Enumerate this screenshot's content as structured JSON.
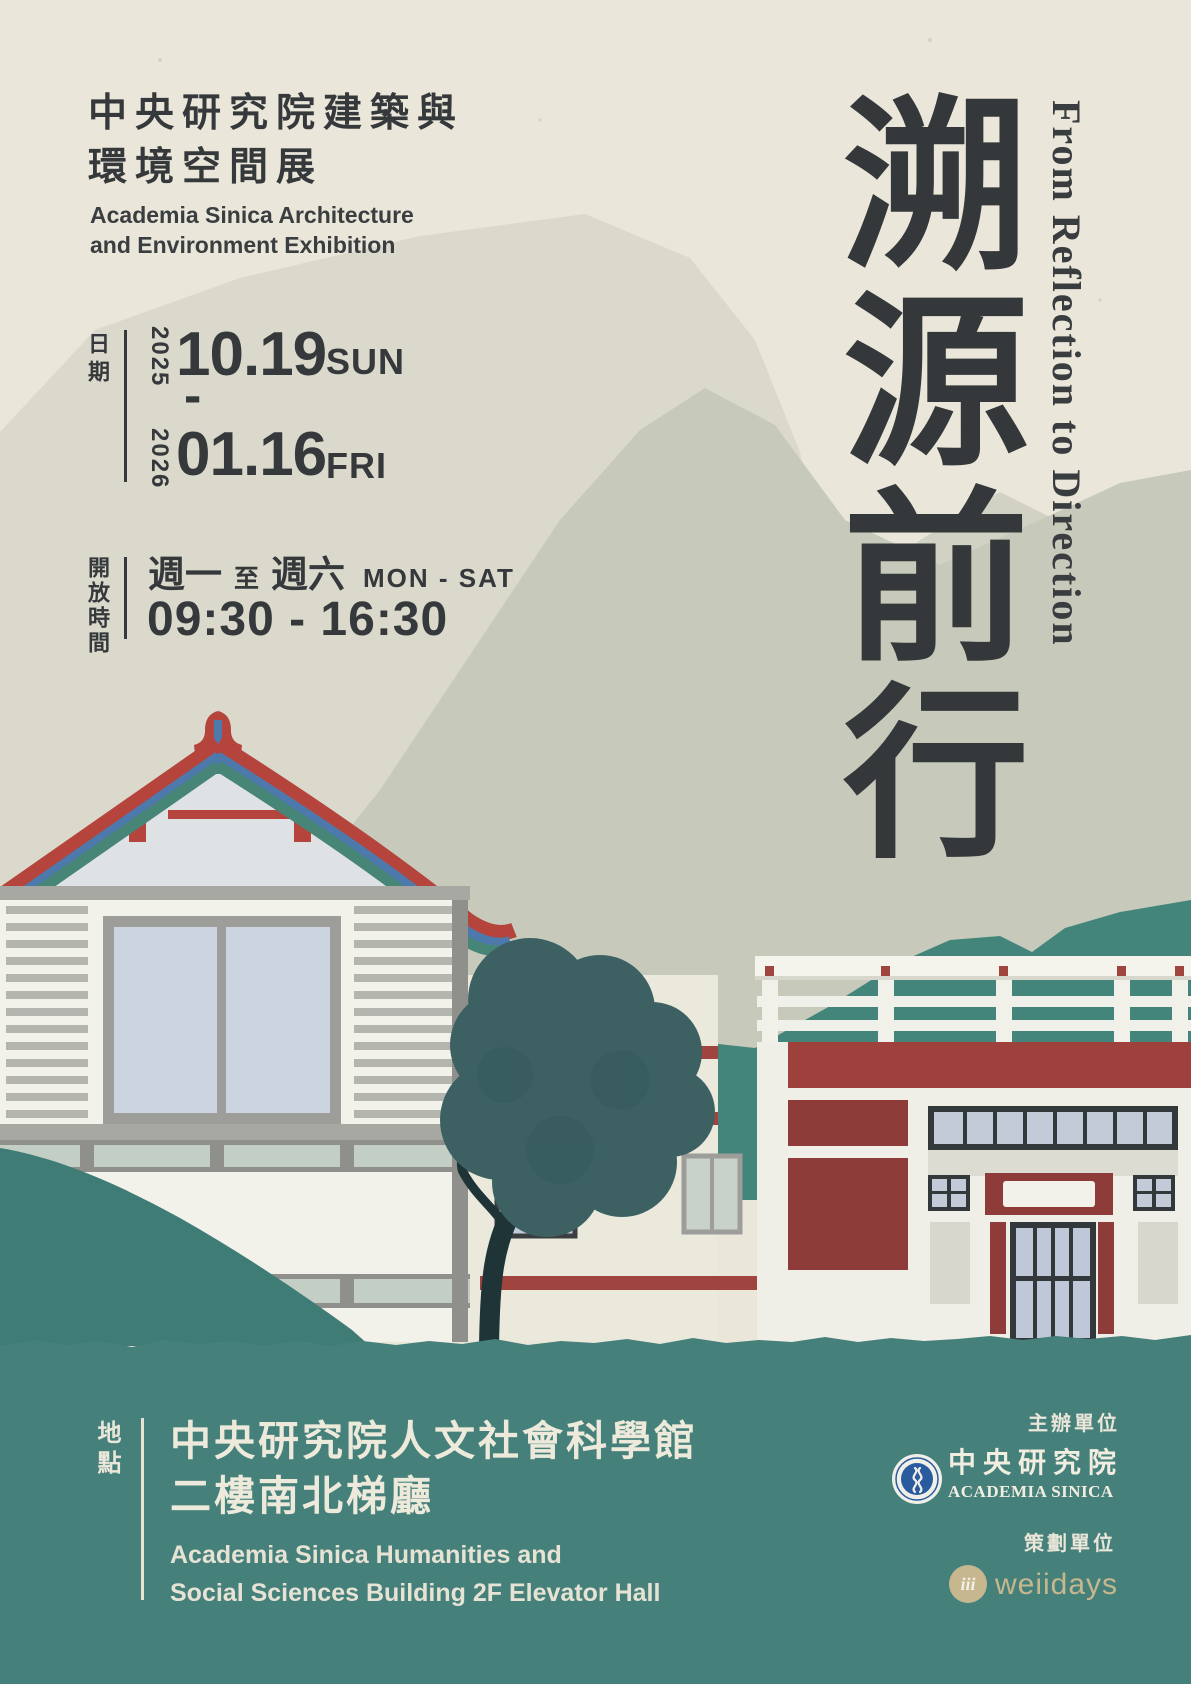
{
  "header": {
    "title_zh_line1": "中央研究院建築與",
    "title_zh_line2": "環境空間展",
    "title_en_line1": "Academia Sinica Architecture",
    "title_en_line2": "and Environment Exhibition"
  },
  "main_title": {
    "zh_vertical": "溯源前行",
    "en_vertical": "From Reflection to Direction"
  },
  "date": {
    "label": "日期",
    "start_year": "2025",
    "start_date": "10.19",
    "start_day": "SUN",
    "range_separator": "-",
    "end_year": "2026",
    "end_date": "01.16",
    "end_day": "FRI"
  },
  "hours": {
    "label": "開放時間",
    "weekday_start": "週一",
    "weekday_to": "至",
    "weekday_end": "週六",
    "weekdays_en": "MON - SAT",
    "time_range": "09:30 - 16:30"
  },
  "location": {
    "label": "地點",
    "zh_line1": "中央研究院人文社會科學館",
    "zh_line2": "二樓南北梯廳",
    "en_line1": "Academia Sinica Humanities and",
    "en_line2": "Social Sciences Building 2F Elevator Hall"
  },
  "organizer": {
    "label": "主辦單位",
    "name_zh": "中央研究院",
    "name_en": "ACADEMIA SINICA",
    "logo_icon": "academia-sinica-seal"
  },
  "planner": {
    "label": "策劃單位",
    "name": "weiidays",
    "logo_icon": "weiidays-mark",
    "logo_text": "iii"
  },
  "colors": {
    "paper": "#eae7da",
    "charcoal": "#35393b",
    "teal_green": "#45807a",
    "roof_red": "#b5443c",
    "brick_maroon": "#8a3a38",
    "roof_blue": "#4d79ac",
    "tan": "#c6b78e",
    "seal_blue": "#2a5b9f"
  }
}
